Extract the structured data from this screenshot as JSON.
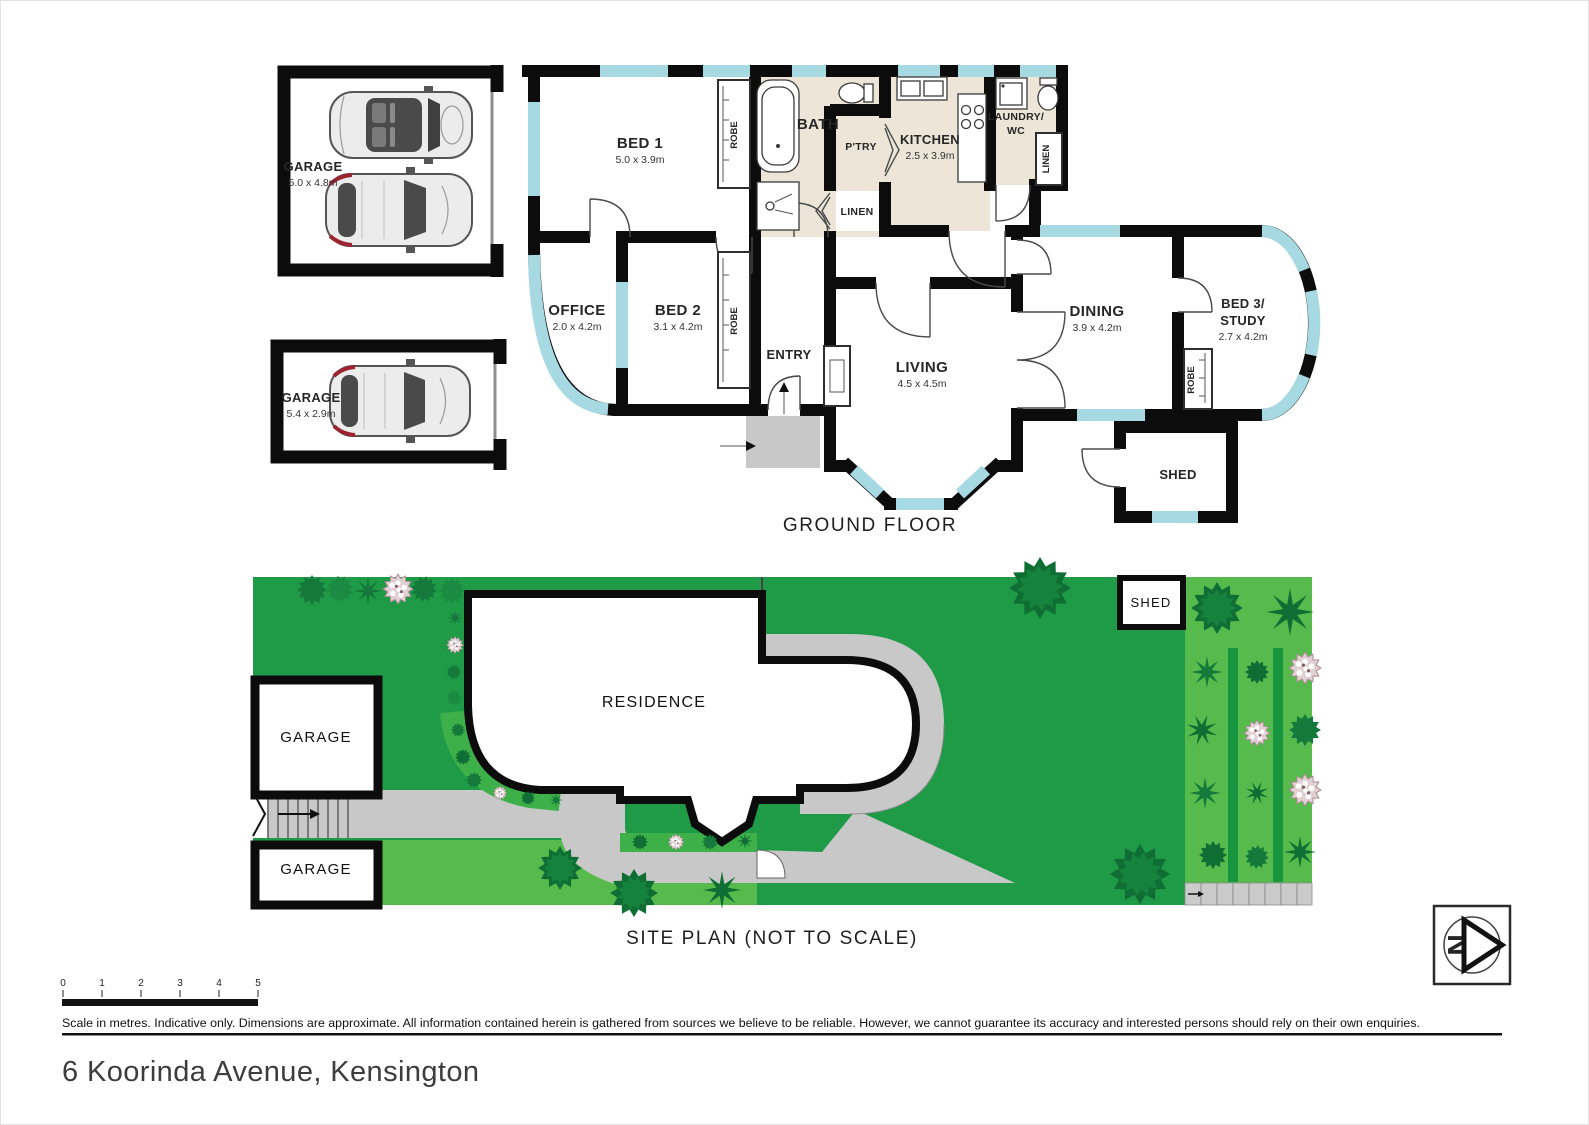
{
  "document": {
    "address": "6 Koorinda Avenue, Kensington",
    "disclaimer": "Scale in metres. Indicative only. Dimensions are approximate. All information contained herein is gathered from sources we believe to be reliable. However, we cannot guarantee its accuracy and interested persons should rely on their own enquiries."
  },
  "floorplan": {
    "caption": "GROUND FLOOR",
    "garage_double": {
      "label": "GARAGE",
      "dims": "5.0 x 4.8m"
    },
    "garage_single": {
      "label": "GARAGE",
      "dims": "5.4 x 2.9m"
    },
    "bed1": {
      "label": "BED 1",
      "dims": "5.0 x 3.9m"
    },
    "bath": {
      "label": "BATH"
    },
    "pantry": {
      "label": "P'TRY"
    },
    "kitchen": {
      "label": "KITCHEN",
      "dims": "2.5 x 3.9m"
    },
    "laundry": {
      "label_line1": "LAUNDRY/",
      "label_line2": "WC"
    },
    "linen": {
      "label": "LINEN"
    },
    "robe": {
      "label": "ROBE"
    },
    "office": {
      "label": "OFFICE",
      "dims": "2.0 x 4.2m"
    },
    "bed2": {
      "label": "BED 2",
      "dims": "3.1 x 4.2m"
    },
    "entry": {
      "label": "ENTRY"
    },
    "living": {
      "label": "LIVING",
      "dims": "4.5 x 4.5m"
    },
    "dining": {
      "label": "DINING",
      "dims": "3.9 x 4.2m"
    },
    "bed3": {
      "label_line1": "BED 3/",
      "label_line2": "STUDY",
      "dims": "2.7 x 4.2m"
    },
    "shed": {
      "label": "SHED"
    }
  },
  "siteplan": {
    "caption": "SITE PLAN (NOT TO SCALE)",
    "residence": "RESIDENCE",
    "garage_upper": "GARAGE",
    "garage_lower": "GARAGE",
    "shed": "SHED"
  },
  "scalebar": {
    "ticks": [
      "0",
      "1",
      "2",
      "3",
      "4",
      "5"
    ]
  },
  "compass": {
    "letter": "N"
  },
  "colors": {
    "wall": "#0c0c0c",
    "window": "#a6d9e2",
    "wet_area": "#ece5d8",
    "lawn_dark": "#1f9a47",
    "lawn_light": "#56bb4c",
    "garden_bed": "#3db049",
    "hedge": "#17953f",
    "path": "#c8c8c8"
  }
}
